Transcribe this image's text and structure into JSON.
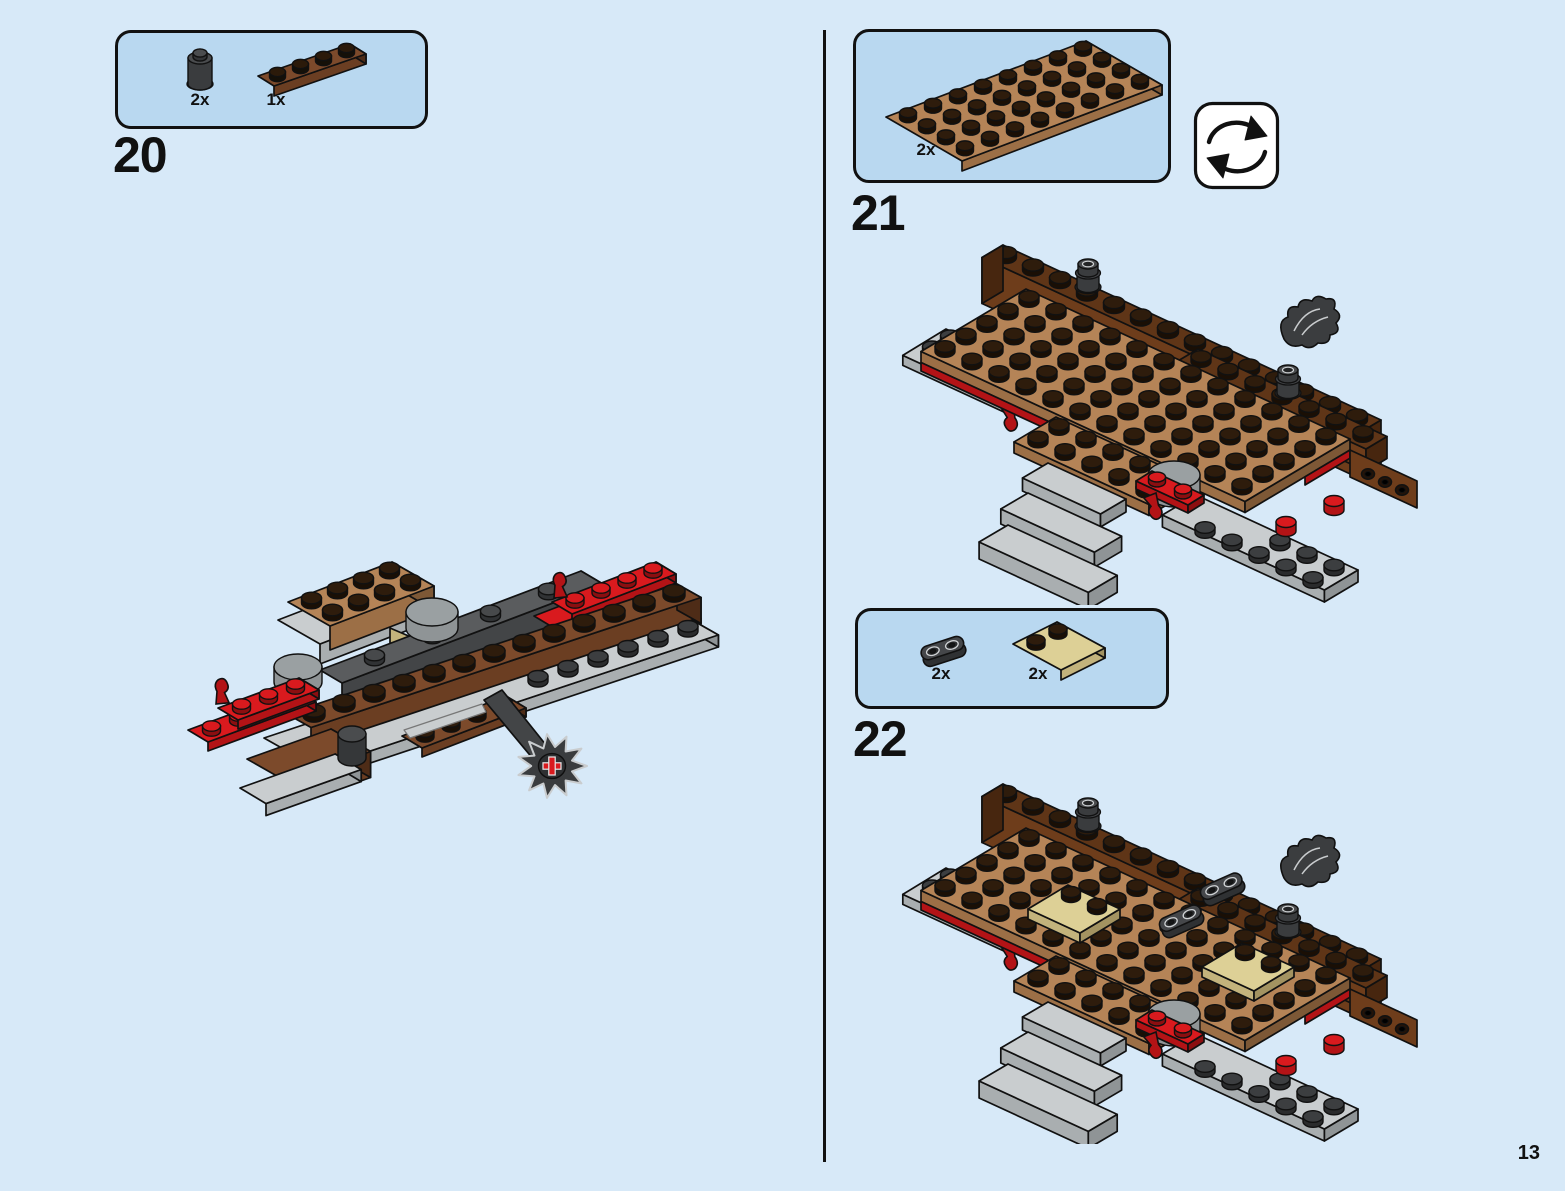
{
  "page": {
    "number": "13"
  },
  "colors": {
    "background": "#d7e9f8",
    "panel_fill": "#b9d8f0",
    "panel_border": "#111111",
    "text": "#111111",
    "outline": "#111111",
    "reddish_brown_top": "#7c4a2b",
    "reddish_brown_face": "#6b3e22",
    "reddish_brown_side": "#4e2c17",
    "dark_brown_top": "#5f3517",
    "dark_brown_face": "#6e3d1b",
    "dark_brown_side": "#47260f",
    "nougat_top": "#b58457",
    "nougat_face": "#9c6f46",
    "nougat_side": "#7d5836",
    "red_top": "#d91a1e",
    "red_face": "#b31316",
    "red_side": "#8c0e10",
    "gray_top": "#c9cdcf",
    "gray_face": "#a9aeb0",
    "gray_side": "#8f9496",
    "dark_gray_top": "#5a5c5e",
    "dark_gray_face": "#434547",
    "dark_gray_side": "#2f3133",
    "tan_top": "#ddd096",
    "tan_face": "#c3b37c",
    "tan_side": "#a39361",
    "stud_dark_side": "#1a0f05",
    "stud_dark_top": "#2e1c0c",
    "rotate_icon_bg": "#ffffff"
  },
  "steps": [
    {
      "number": "20",
      "parts": [
        {
          "name": "dark-gray 1x1 round brick",
          "count": "2x"
        },
        {
          "name": "reddish-brown 1x4 plate",
          "count": "1x"
        }
      ]
    },
    {
      "number": "21",
      "rotate_icon": "rotate-model-symbol",
      "parts": [
        {
          "name": "medium-nougat 4x8 plate",
          "count": "2x"
        }
      ]
    },
    {
      "number": "22",
      "parts": [
        {
          "name": "dark-gray 1x2 round plate with open studs",
          "count": "2x"
        },
        {
          "name": "tan 2x2 plate with 2 studs",
          "count": "2x"
        }
      ]
    }
  ]
}
